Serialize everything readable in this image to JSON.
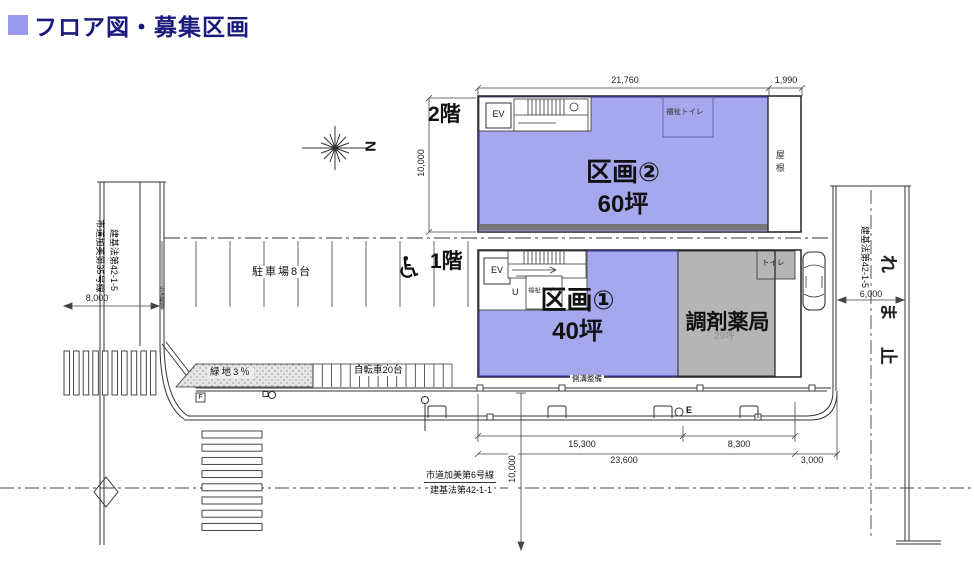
{
  "title": "フロア図・募集区画",
  "north_label": "N",
  "floor2": {
    "label": "2階",
    "unit": "区画②",
    "area": "60坪",
    "ev": "EV",
    "toilet": "福祉トイレ",
    "roof": "屋根",
    "dims": {
      "width": "21,760",
      "right": "1,990",
      "height": "10,000"
    }
  },
  "floor1": {
    "label": "1階",
    "unit": "区画①",
    "area": "40坪",
    "pharmacy": "調剤薬局",
    "pharmacy_area": "29坪",
    "ev": "EV",
    "up": "U",
    "toilet": "福祉トイ",
    "toilet2": "トイレ"
  },
  "site": {
    "parking": "駐車場8台",
    "green": "緑地3％",
    "bicycle": "自転車20台",
    "gutter_note": "側溝整備",
    "sidewalk_note": "歩道整備",
    "pole_e": "E",
    "f_mark": "F"
  },
  "roads": {
    "left": {
      "name": "市道加美第35号線",
      "law": "建基法第42-1-5",
      "width": "8,000"
    },
    "right": {
      "law": "建基法第42-1-5",
      "width": "6,000",
      "marking": [
        "れ",
        "ま",
        "止"
      ]
    },
    "bottom": {
      "name": "市道加美第6号線",
      "law": "建基法第42-1-1",
      "width": "10,000"
    }
  },
  "dimensions": {
    "frontage_left": "15,300",
    "frontage_right": "8,300",
    "total": "23,600",
    "side": "3,000"
  },
  "colors": {
    "unit_fill": "#a6a8ee",
    "pharmacy_fill": "#b5b5b5",
    "accent": "#9a9aec",
    "title": "#1b1b7e"
  }
}
